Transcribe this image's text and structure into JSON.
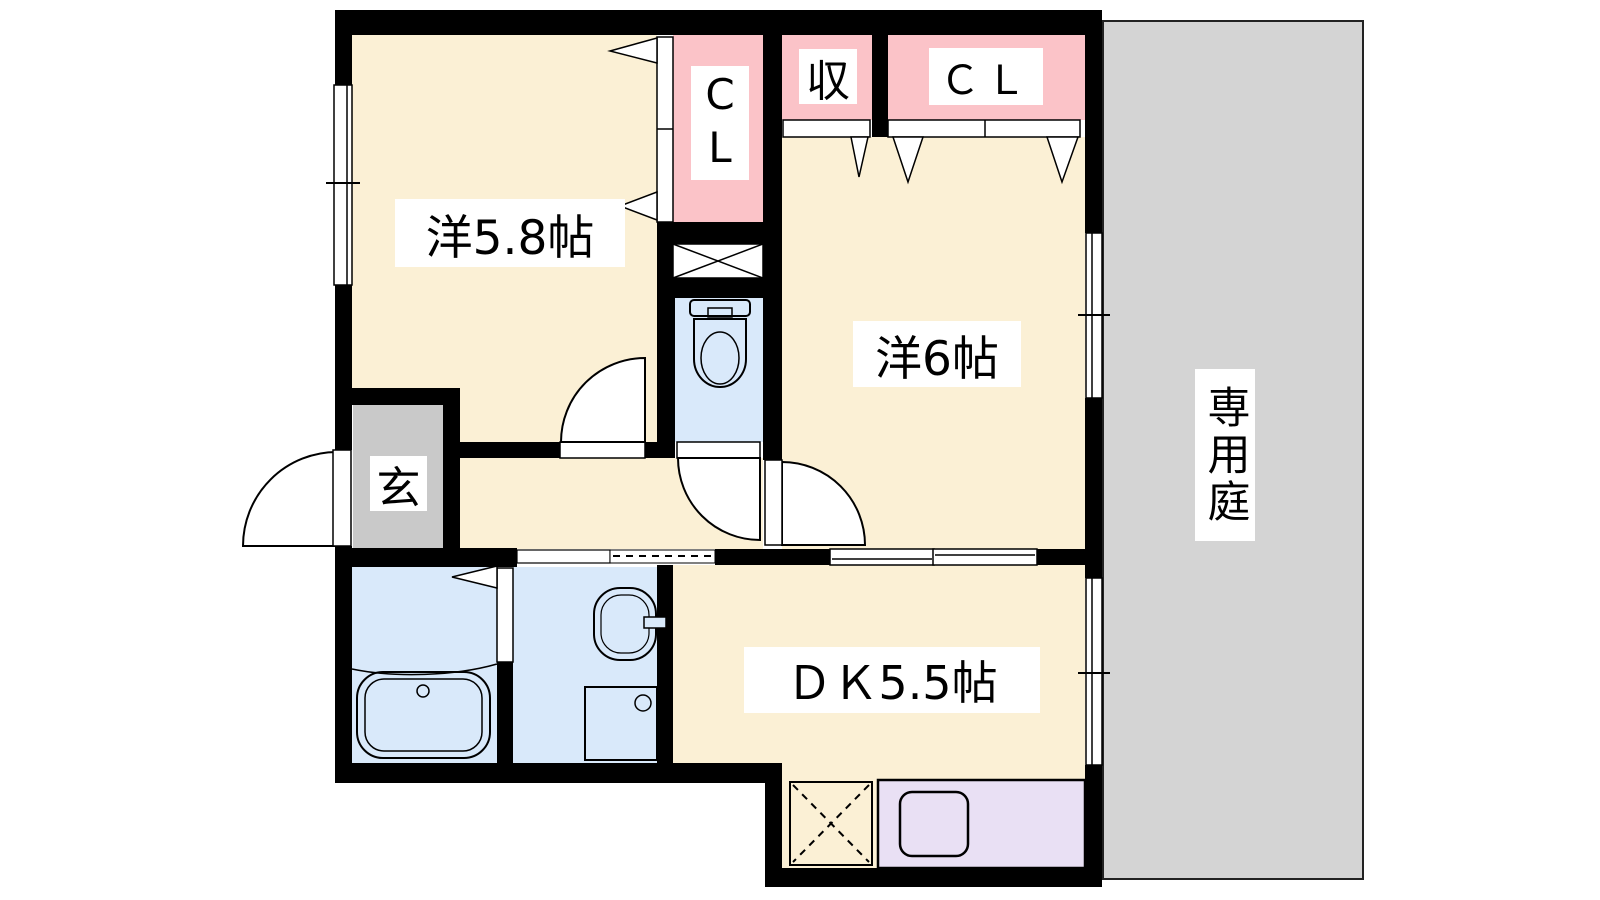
{
  "labels": {
    "room_west58": "洋5.8帖",
    "room_west6": "洋6帖",
    "room_dk": "ＤＫ5.5帖",
    "entrance": "玄",
    "closet_vertical": "CL",
    "storage": "収",
    "closet_top": "ＣＬ",
    "garden": "専用庭"
  },
  "colors": {
    "floor_cream": "#FBF0D5",
    "closet_pink": "#FBC3C8",
    "wet_blue": "#D9E9FA",
    "entrance_gray": "#C9C9C9",
    "garden_gray": "#D4D4D4",
    "kitchen_purple": "#E9E0F4",
    "wall_black": "#000000",
    "line_black": "#000000"
  },
  "fixtures": {
    "toilet": "toilet-icon",
    "bathtub": "bathtub-icon",
    "washbasin": "washbasin-icon",
    "washing_machine": "washing-machine-pan-icon",
    "kitchen_sink": "kitchen-sink-icon",
    "refrigerator_space": "refrigerator-space-icon",
    "pipe_space": "pipe-space-icon"
  }
}
